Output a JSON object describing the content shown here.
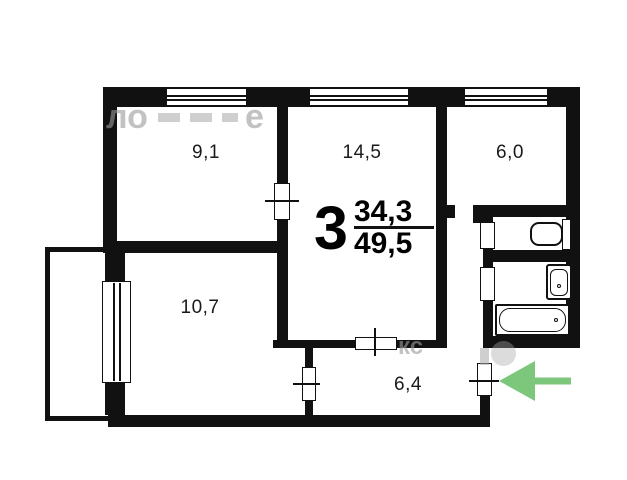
{
  "plan": {
    "title_number": "3",
    "area_living": "34,3",
    "area_total": "49,5",
    "rooms": [
      {
        "name": "bedroom-1",
        "area": "9,1"
      },
      {
        "name": "living-room",
        "area": "14,5"
      },
      {
        "name": "kitchen",
        "area": "6,0"
      },
      {
        "name": "bedroom-2",
        "area": "10,7"
      },
      {
        "name": "hallway",
        "area": "6,4"
      }
    ],
    "fixtures": [
      {
        "name": "toilet"
      },
      {
        "name": "sink"
      },
      {
        "name": "bathtub"
      }
    ],
    "entrance": {
      "arrow_color": "#7dc77d",
      "direction": "left"
    },
    "colors": {
      "wall": "#111111",
      "background": "#ffffff",
      "watermark": "#9b9b9b"
    },
    "watermark": {
      "top_text": "ло",
      "top_text2": "е",
      "bottom_text": "кс"
    }
  }
}
